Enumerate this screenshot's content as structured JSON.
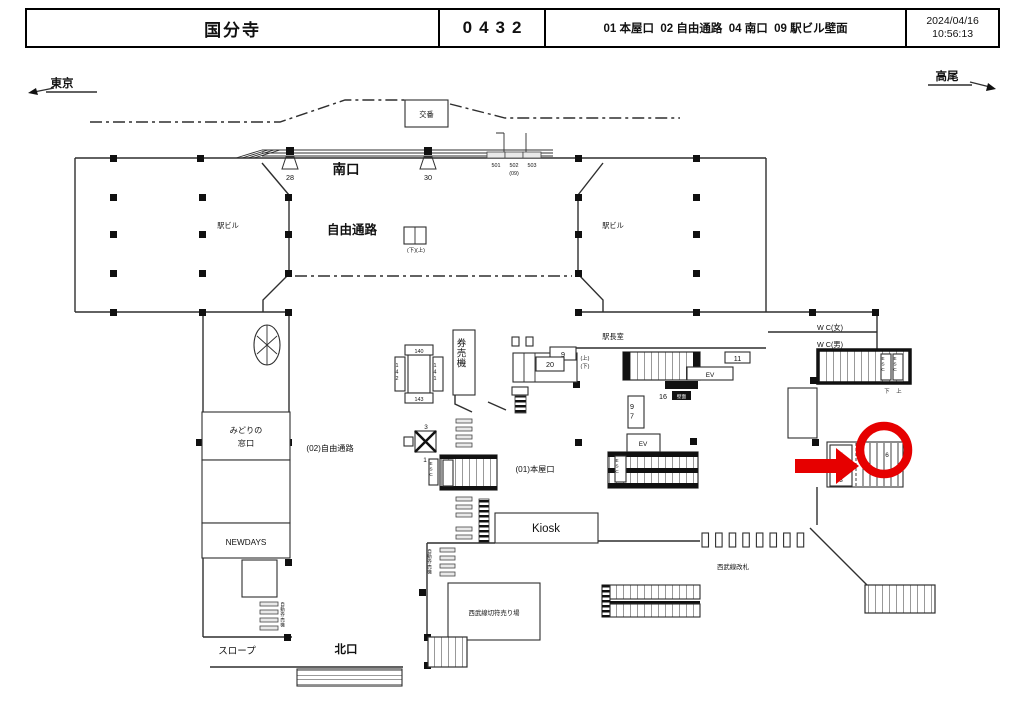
{
  "header": {
    "station_name": "国分寺",
    "station_code": "0432",
    "locations": "01 本屋口  02 自由通路  04 南口  09 駅ビル壁面",
    "date": "2024/04/16",
    "time": "10:56:13"
  },
  "map": {
    "highlight_color": "#e60000",
    "labels": {
      "tokyo": "東京",
      "takao": "高尾",
      "koban": "交番",
      "minamiguchi": "南口",
      "jiyu_tsuro": "自由通路",
      "ekibiru": "駅ビル",
      "sign_28": "28",
      "sign_30": "30",
      "sign_501": "501",
      "sign_502": "502",
      "sign_503": "503",
      "sign_09": "(09)",
      "updown_top": "(下)(上)",
      "ekichoshitsu": "駅長室",
      "kenbaiki": "券売機",
      "sign_9": "9",
      "sign_20": "20",
      "up": "(上)",
      "down": "(下)",
      "sign_11": "11",
      "ev": "EV",
      "sign_16": "16",
      "kabemen": "壁面",
      "sign_97": "97",
      "wc_women": "W C(女)",
      "wc_men": "W C(男)",
      "esc": "ESC",
      "down_kanji": "下",
      "up_kanji": "上",
      "midori_line1": "みどりの",
      "midori_line2": "窓口",
      "newdays": "NEWDAYS",
      "jiyu_tsuro_02": "(02)自由通路",
      "sign_3": "3",
      "sign_1": "1",
      "sign_140": "140",
      "sign_141": "141",
      "sign_142": "142",
      "sign_143": "143",
      "honya_01": "(01)本屋口",
      "kiosk": "Kiosk",
      "sign_5": "5",
      "sign_6": "6",
      "seibu_kaisatsu": "西武線改札",
      "seibu_kippu": "西武線切符売り場",
      "jidou_kenbaiki": "自動券売機",
      "slope": "スロープ",
      "kitaguchi": "北口"
    }
  }
}
